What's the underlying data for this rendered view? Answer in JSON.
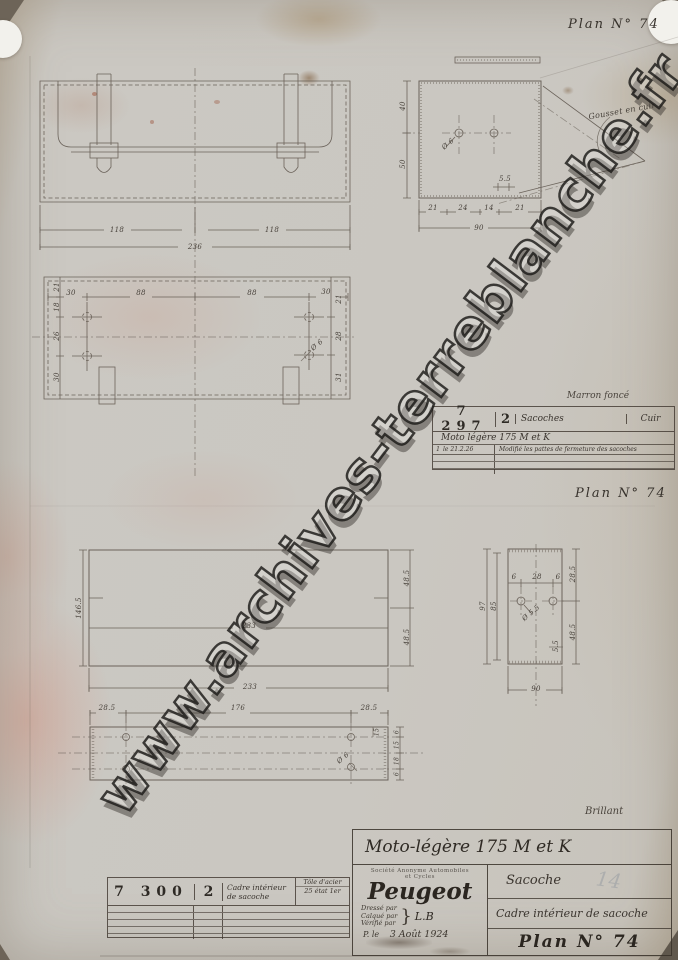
{
  "sheet": {
    "plan_label_top": "Plan N° 74",
    "plan_label_mid": "Plan N° 74",
    "watermark": "www.archives-terreblanche.fr",
    "finish_note": "Brillant",
    "pencil_note": "14"
  },
  "front_view": {
    "dims": {
      "left": "118",
      "right": "118",
      "total": "236"
    }
  },
  "back_view": {
    "dims": {
      "t1": "30",
      "t2": "88",
      "t3": "88",
      "t4": "30",
      "l1": "21",
      "l2": "18",
      "l3": "26",
      "l4": "30",
      "r1": "21",
      "r2": "28",
      "r3": "31",
      "hole": "Ø 6"
    }
  },
  "side_view": {
    "gusset_label": "Gousset en cuir",
    "dims": {
      "v1": "40",
      "v2": "50",
      "hole": "Ø 6",
      "notch": "5.5",
      "b1": "21",
      "b2": "24",
      "b3": "14",
      "b4": "21",
      "total": "90"
    }
  },
  "frame_view": {
    "dims": {
      "width_mid": "233",
      "width_total": "233",
      "height": "146.5",
      "r1": "48.5",
      "r2": "48.5"
    }
  },
  "frame_side": {
    "dims": {
      "t1": "6",
      "t2": "28",
      "t3": "6",
      "hole": "Ø 5.5",
      "l_outer": "97",
      "l_inner": "85",
      "r1": "28.5",
      "r2": "48.5",
      "notch": "5.5",
      "total": "90"
    }
  },
  "strip_view": {
    "dims": {
      "left": "28.5",
      "mid": "176",
      "right": "28.5",
      "inner": "15",
      "s1": "6",
      "s2": "15",
      "s3": "18",
      "s4": "6",
      "hole": "Ø 6"
    }
  },
  "sacoche_table": {
    "color_note": "Marron foncé",
    "ref": "7 297",
    "qty": "2",
    "designation": "Sacoches",
    "material": "Cuir",
    "model_line": "Moto légère 175 M et K",
    "revision_index": "1",
    "revision_date": "le 21.2.26",
    "revision_text": "Modifié les pattes de fermeture des sacoches"
  },
  "cadre_table": {
    "ref": "7 300",
    "qty": "2",
    "designation": "Cadre intérieur de sacoche",
    "material_line1": "Tôle d'acier",
    "material_line2": "25 état 1er"
  },
  "title_block": {
    "model_line": "Moto-légère 175 M et K",
    "company_line1": "Société Anonyme Automobiles",
    "company_line2": "et Cycles",
    "logo": "Peugeot",
    "drawn_label": "Dressé par",
    "traced_label": "Calqué par",
    "checked_label": "Vérifié par",
    "initials": "L.B",
    "date_prefix": "P. le",
    "date": "3 Août 1924",
    "part_title": "Sacoche",
    "part_subtitle": "Cadre intérieur de sacoche",
    "plan_label": "Plan N° 74"
  }
}
